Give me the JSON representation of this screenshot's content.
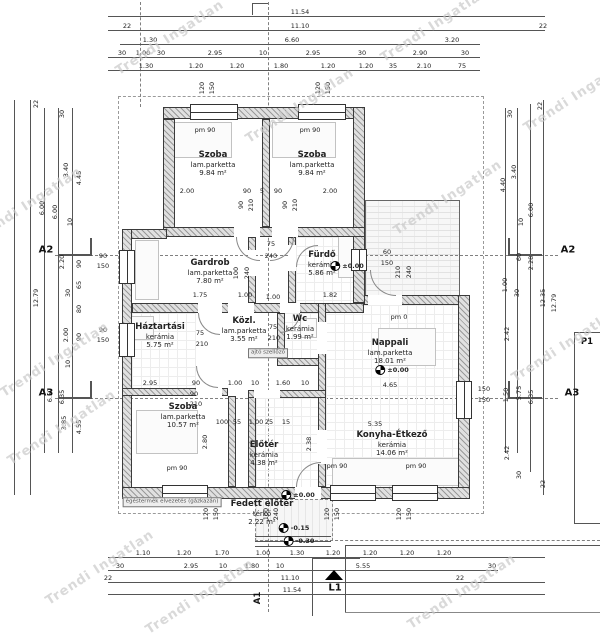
{
  "watermark": {
    "text": "Trendi Ingatlan",
    "color": "#c9c9c9"
  },
  "markers": {
    "a2": "A2",
    "a3": "A3",
    "p1": "P1",
    "l1": "L1",
    "a1": "A1"
  },
  "plan": {
    "rooms": [
      {
        "name": "Szoba",
        "floor": "lam.parketta",
        "area": "9.84 m²",
        "x": 213,
        "y": 150
      },
      {
        "name": "Szoba",
        "floor": "lam.parketta",
        "area": "9.84 m²",
        "x": 312,
        "y": 150
      },
      {
        "name": "Gardrob",
        "floor": "lam.parketta",
        "area": "7.80 m²",
        "x": 210,
        "y": 258
      },
      {
        "name": "Fürdő",
        "floor": "kerámia",
        "area": "5.86 m²",
        "x": 322,
        "y": 250
      },
      {
        "name": "Háztartási",
        "floor": "kerámia",
        "area": "5.75 m²",
        "x": 160,
        "y": 322
      },
      {
        "name": "Közl.",
        "floor": "lam.parketta",
        "area": "3.55 m²",
        "x": 244,
        "y": 316
      },
      {
        "name": "Wc",
        "floor": "kerámia",
        "area": "1.99 m²",
        "x": 300,
        "y": 314
      },
      {
        "name": "Nappali",
        "floor": "lam.parketta",
        "area": "18.01 m²",
        "x": 390,
        "y": 338
      },
      {
        "name": "Szoba",
        "floor": "lam.parketta",
        "area": "10.57 m²",
        "x": 183,
        "y": 402
      },
      {
        "name": "Előtér",
        "floor": "kerámia",
        "area": "4.38 m²",
        "x": 264,
        "y": 440
      },
      {
        "name": "Konyha-Étkező",
        "floor": "kerámia",
        "area": "14.06 m²",
        "x": 392,
        "y": 430
      },
      {
        "name": "Fedett előtér",
        "floor": "térkő",
        "area": "2.22 m²",
        "x": 262,
        "y": 499
      }
    ],
    "walls": [
      [
        163,
        107,
        202,
        12
      ],
      [
        163,
        119,
        12,
        118
      ],
      [
        353,
        107,
        12,
        196
      ],
      [
        262,
        119,
        8,
        108
      ],
      [
        163,
        227,
        202,
        10
      ],
      [
        122,
        229,
        45,
        10
      ],
      [
        122,
        229,
        10,
        268
      ],
      [
        132,
        303,
        232,
        10
      ],
      [
        248,
        237,
        8,
        66
      ],
      [
        288,
        237,
        8,
        66
      ],
      [
        364,
        295,
        106,
        10
      ],
      [
        458,
        295,
        12,
        204
      ],
      [
        122,
        487,
        348,
        12
      ],
      [
        122,
        388,
        106,
        8
      ],
      [
        228,
        396,
        8,
        91
      ],
      [
        277,
        313,
        8,
        50
      ],
      [
        277,
        358,
        49,
        8
      ],
      [
        318,
        303,
        8,
        93
      ],
      [
        318,
        396,
        8,
        91
      ],
      [
        248,
        396,
        8,
        91
      ],
      [
        248,
        390,
        78,
        8
      ]
    ],
    "gaps": [
      [
        234,
        227,
        26,
        10
      ],
      [
        272,
        227,
        26,
        10
      ],
      [
        248,
        250,
        8,
        26
      ],
      [
        288,
        245,
        8,
        26
      ],
      [
        198,
        303,
        24,
        10
      ],
      [
        228,
        303,
        26,
        10
      ],
      [
        280,
        303,
        20,
        10
      ],
      [
        317,
        322,
        10,
        32
      ],
      [
        317,
        430,
        10,
        34
      ],
      [
        196,
        388,
        26,
        8
      ],
      [
        254,
        390,
        26,
        8
      ],
      [
        295,
        487,
        26,
        12
      ],
      [
        368,
        295,
        34,
        10
      ]
    ],
    "windows": [
      [
        190,
        104,
        48,
        16,
        "h"
      ],
      [
        298,
        104,
        48,
        16,
        "h"
      ],
      [
        119,
        250,
        16,
        34,
        "v"
      ],
      [
        119,
        323,
        16,
        34,
        "v"
      ],
      [
        351,
        249,
        16,
        22,
        "v"
      ],
      [
        456,
        381,
        16,
        38,
        "v"
      ],
      [
        162,
        485,
        46,
        16,
        "h"
      ],
      [
        330,
        485,
        46,
        16,
        "h"
      ],
      [
        392,
        485,
        46,
        16,
        "h"
      ]
    ],
    "tiles": [
      [
        296,
        237,
        57,
        66
      ],
      [
        283,
        313,
        35,
        45
      ],
      [
        256,
        398,
        62,
        89
      ],
      [
        326,
        430,
        132,
        57
      ],
      [
        132,
        313,
        64,
        75
      ],
      [
        326,
        305,
        132,
        125
      ]
    ],
    "furniture": [
      [
        168,
        122,
        62,
        34
      ],
      [
        272,
        122,
        62,
        34
      ],
      [
        135,
        240,
        22,
        58
      ],
      [
        338,
        234,
        18,
        42
      ],
      [
        300,
        318,
        15,
        18
      ],
      [
        136,
        410,
        60,
        42
      ],
      [
        378,
        328,
        56,
        36
      ],
      [
        332,
        458,
        128,
        26
      ],
      [
        130,
        316,
        22,
        22
      ]
    ],
    "arcs": [
      [
        236,
        237,
        24,
        24,
        "bl"
      ],
      [
        270,
        237,
        24,
        24,
        "br"
      ],
      [
        296,
        245,
        22,
        22,
        "tl"
      ],
      [
        198,
        313,
        22,
        22,
        "bl"
      ],
      [
        280,
        313,
        20,
        20,
        "br"
      ],
      [
        196,
        366,
        22,
        22,
        "bl"
      ],
      [
        296,
        462,
        25,
        25,
        "tl"
      ],
      [
        370,
        270,
        26,
        26,
        "bl"
      ]
    ],
    "lines": [
      [
        108,
        16,
        437,
        1
      ],
      [
        108,
        30,
        437,
        1
      ],
      [
        120,
        44,
        360,
        1
      ],
      [
        108,
        57,
        372,
        1
      ],
      [
        108,
        70,
        372,
        1
      ],
      [
        108,
        557,
        437,
        1
      ],
      [
        108,
        570,
        390,
        1
      ],
      [
        108,
        582,
        437,
        1
      ],
      [
        108,
        594,
        437,
        1
      ],
      [
        14,
        100,
        1,
        395
      ],
      [
        30,
        100,
        1,
        395
      ],
      [
        44,
        108,
        1,
        345
      ],
      [
        58,
        108,
        1,
        345
      ],
      [
        72,
        108,
        1,
        345
      ],
      [
        543,
        100,
        1,
        395
      ],
      [
        530,
        104,
        1,
        368
      ],
      [
        517,
        108,
        1,
        345
      ],
      [
        505,
        108,
        1,
        345
      ],
      [
        58,
        254,
        34,
        2
      ],
      [
        90,
        238,
        2,
        18
      ],
      [
        508,
        254,
        34,
        2
      ],
      [
        508,
        238,
        2,
        18
      ],
      [
        58,
        397,
        34,
        2
      ],
      [
        90,
        381,
        2,
        17
      ],
      [
        508,
        397,
        34,
        2
      ],
      [
        508,
        381,
        2,
        17
      ],
      [
        312,
        558,
        1,
        58
      ],
      [
        312,
        558,
        48,
        1
      ],
      [
        255,
        536,
        76,
        1
      ],
      [
        255,
        541,
        76,
        1
      ],
      [
        255,
        546,
        76,
        1
      ],
      [
        252,
        3,
        1,
        12
      ],
      [
        252,
        3,
        16,
        1
      ],
      [
        345,
        545,
        255,
        1
      ],
      [
        345,
        545,
        1,
        67
      ]
    ],
    "dims": [
      [
        "11.54",
        300,
        12
      ],
      [
        "22",
        127,
        26
      ],
      [
        "11.10",
        300,
        26
      ],
      [
        "22",
        543,
        26
      ],
      [
        "1.30",
        150,
        40
      ],
      [
        "6.60",
        292,
        40
      ],
      [
        "3.20",
        452,
        40
      ],
      [
        "30",
        122,
        53
      ],
      [
        "1.00",
        143,
        53
      ],
      [
        "30",
        161,
        53
      ],
      [
        "2.95",
        215,
        53
      ],
      [
        "10",
        263,
        53
      ],
      [
        "2.95",
        313,
        53
      ],
      [
        "30",
        362,
        53
      ],
      [
        "2.90",
        420,
        53
      ],
      [
        "30",
        465,
        53
      ],
      [
        "1.30",
        146,
        66
      ],
      [
        "1.20",
        196,
        66
      ],
      [
        "1.20",
        237,
        66
      ],
      [
        "1.80",
        281,
        66
      ],
      [
        "1.20",
        328,
        66
      ],
      [
        "1.20",
        366,
        66
      ],
      [
        "35",
        393,
        66
      ],
      [
        "2.10",
        424,
        66
      ],
      [
        "75",
        462,
        66
      ],
      [
        "120",
        202,
        88,
        -90
      ],
      [
        "150",
        212,
        88,
        -90
      ],
      [
        "120",
        318,
        88,
        -90
      ],
      [
        "150",
        328,
        88,
        -90
      ],
      [
        "22",
        36,
        104,
        -90
      ],
      [
        "30",
        62,
        114,
        -90
      ],
      [
        "3.40",
        66,
        170,
        -90
      ],
      [
        "4.45",
        79,
        178,
        -90
      ],
      [
        "6.00",
        42,
        208,
        -90
      ],
      [
        "6.00",
        55,
        212,
        -90
      ],
      [
        "10",
        70,
        222,
        -90
      ],
      [
        "2.20",
        62,
        262,
        -90
      ],
      [
        "90",
        79,
        264,
        -90
      ],
      [
        "65",
        79,
        285,
        -90
      ],
      [
        "30",
        68,
        293,
        -90
      ],
      [
        "80",
        79,
        309,
        -90
      ],
      [
        "12.79",
        36,
        298,
        -90
      ],
      [
        "2.00",
        66,
        335,
        -90
      ],
      [
        "90",
        79,
        337,
        -90
      ],
      [
        "10",
        68,
        364,
        -90
      ],
      [
        "6.57",
        50,
        395,
        -90
      ],
      [
        "6.35",
        62,
        397,
        -90
      ],
      [
        "3.85",
        64,
        423,
        -90
      ],
      [
        "4.55",
        79,
        427,
        -90
      ],
      [
        "90",
        103,
        256
      ],
      [
        "150",
        103,
        266
      ],
      [
        "90",
        103,
        330
      ],
      [
        "150",
        103,
        340
      ],
      [
        "30",
        510,
        114,
        -90
      ],
      [
        "22",
        540,
        106,
        -90
      ],
      [
        "3.40",
        514,
        172,
        -90
      ],
      [
        "4.40",
        503,
        185,
        -90
      ],
      [
        "6.00",
        531,
        210,
        -90
      ],
      [
        "10",
        521,
        222,
        -90
      ],
      [
        "60",
        519,
        257,
        -90
      ],
      [
        "2.28",
        531,
        263,
        -90
      ],
      [
        "1.00",
        505,
        285,
        -90
      ],
      [
        "30",
        517,
        293,
        -90
      ],
      [
        "12.35",
        543,
        298,
        -90
      ],
      [
        "12.79",
        554,
        303,
        -90
      ],
      [
        "2.42",
        507,
        334,
        -90
      ],
      [
        "150",
        484,
        389
      ],
      [
        "150",
        484,
        400
      ],
      [
        "1.50",
        506,
        395,
        -90
      ],
      [
        "5.75",
        519,
        393,
        -90
      ],
      [
        "6.35",
        531,
        397,
        -90
      ],
      [
        "2.42",
        507,
        453,
        -90
      ],
      [
        "30",
        519,
        475,
        -90
      ],
      [
        "22",
        543,
        484,
        -90
      ],
      [
        "1.10",
        143,
        553
      ],
      [
        "1.20",
        184,
        553
      ],
      [
        "1.70",
        222,
        553
      ],
      [
        "1.00",
        263,
        553
      ],
      [
        "1.30",
        297,
        553
      ],
      [
        "1.20",
        333,
        553
      ],
      [
        "1.20",
        370,
        553
      ],
      [
        "1.20",
        407,
        553
      ],
      [
        "1.20",
        444,
        553
      ],
      [
        "30",
        120,
        566
      ],
      [
        "2.95",
        191,
        566
      ],
      [
        "10",
        223,
        566
      ],
      [
        "1.80",
        252,
        566
      ],
      [
        "10",
        280,
        566
      ],
      [
        "5.55",
        363,
        566
      ],
      [
        "30",
        492,
        566
      ],
      [
        "22",
        108,
        578
      ],
      [
        "11.10",
        290,
        578
      ],
      [
        "22",
        460,
        578
      ],
      [
        "11.54",
        292,
        590
      ],
      [
        "120",
        206,
        514,
        -90
      ],
      [
        "150",
        216,
        514,
        -90
      ],
      [
        "120",
        327,
        514,
        -90
      ],
      [
        "150",
        337,
        514,
        -90
      ],
      [
        "120",
        399,
        514,
        -90
      ],
      [
        "150",
        409,
        514,
        -90
      ],
      [
        "pm 90",
        205,
        130
      ],
      [
        "pm 90",
        310,
        130
      ],
      [
        "pm 0",
        399,
        317
      ],
      [
        "pm 90",
        177,
        468
      ],
      [
        "pm 90",
        337,
        466
      ],
      [
        "pm 90",
        416,
        466
      ],
      [
        "2.00",
        187,
        191
      ],
      [
        "90",
        247,
        191
      ],
      [
        "5",
        262,
        191
      ],
      [
        "90",
        278,
        191
      ],
      [
        "2.00",
        330,
        191
      ],
      [
        "90",
        241,
        205,
        -90
      ],
      [
        "210",
        251,
        205,
        -90
      ],
      [
        "90",
        285,
        205,
        -90
      ],
      [
        "210",
        295,
        205,
        -90
      ],
      [
        "75",
        271,
        244
      ],
      [
        "240",
        271,
        256
      ],
      [
        "100",
        236,
        273,
        -90
      ],
      [
        "240",
        247,
        273,
        -90
      ],
      [
        "1.75",
        200,
        295
      ],
      [
        "1.00",
        245,
        295
      ],
      [
        "1.00",
        273,
        297
      ],
      [
        "1.82",
        330,
        295
      ],
      [
        "60",
        387,
        252
      ],
      [
        "150",
        387,
        263
      ],
      [
        "210",
        398,
        272,
        -90
      ],
      [
        "240",
        409,
        272,
        -90
      ],
      [
        "75",
        200,
        333
      ],
      [
        "210",
        202,
        344
      ],
      [
        "75",
        273,
        327
      ],
      [
        "210",
        274,
        338
      ],
      [
        "ajtó szellőző",
        268,
        353,
        0,
        "box"
      ],
      [
        "4.65",
        390,
        385
      ],
      [
        "5.35",
        375,
        424
      ],
      [
        "2.38",
        309,
        444,
        -90
      ],
      [
        "2.95",
        150,
        383
      ],
      [
        "90",
        196,
        383
      ],
      [
        "1.00",
        235,
        383
      ],
      [
        "10",
        255,
        383
      ],
      [
        "1.60",
        283,
        383
      ],
      [
        "10",
        305,
        383
      ],
      [
        "90",
        194,
        394
      ],
      [
        "210",
        196,
        404
      ],
      [
        "100",
        222,
        422
      ],
      [
        "55",
        237,
        422
      ],
      [
        "1.00",
        256,
        422
      ],
      [
        "25",
        269,
        422
      ],
      [
        "15",
        286,
        422
      ],
      [
        "2.80",
        205,
        442,
        -90
      ],
      [
        "100",
        266,
        514,
        -90
      ],
      [
        "240",
        276,
        514,
        -90
      ],
      [
        "égéstermék elvezetés (gázkazán)",
        172,
        502,
        0,
        "box"
      ]
    ],
    "levels": [
      [
        "±0.00",
        347,
        266
      ],
      [
        "±0.00",
        392,
        370
      ],
      [
        "±0.00",
        298,
        495
      ],
      [
        "-0.15",
        294,
        528
      ],
      [
        "-0.30",
        299,
        541
      ]
    ],
    "watermarks": [
      [
        170,
        38
      ],
      [
        435,
        25
      ],
      [
        578,
        95
      ],
      [
        28,
        205
      ],
      [
        300,
        106
      ],
      [
        448,
        198
      ],
      [
        62,
        428
      ],
      [
        566,
        345
      ],
      [
        100,
        568
      ],
      [
        200,
        597
      ],
      [
        462,
        592
      ],
      [
        55,
        360
      ]
    ]
  }
}
